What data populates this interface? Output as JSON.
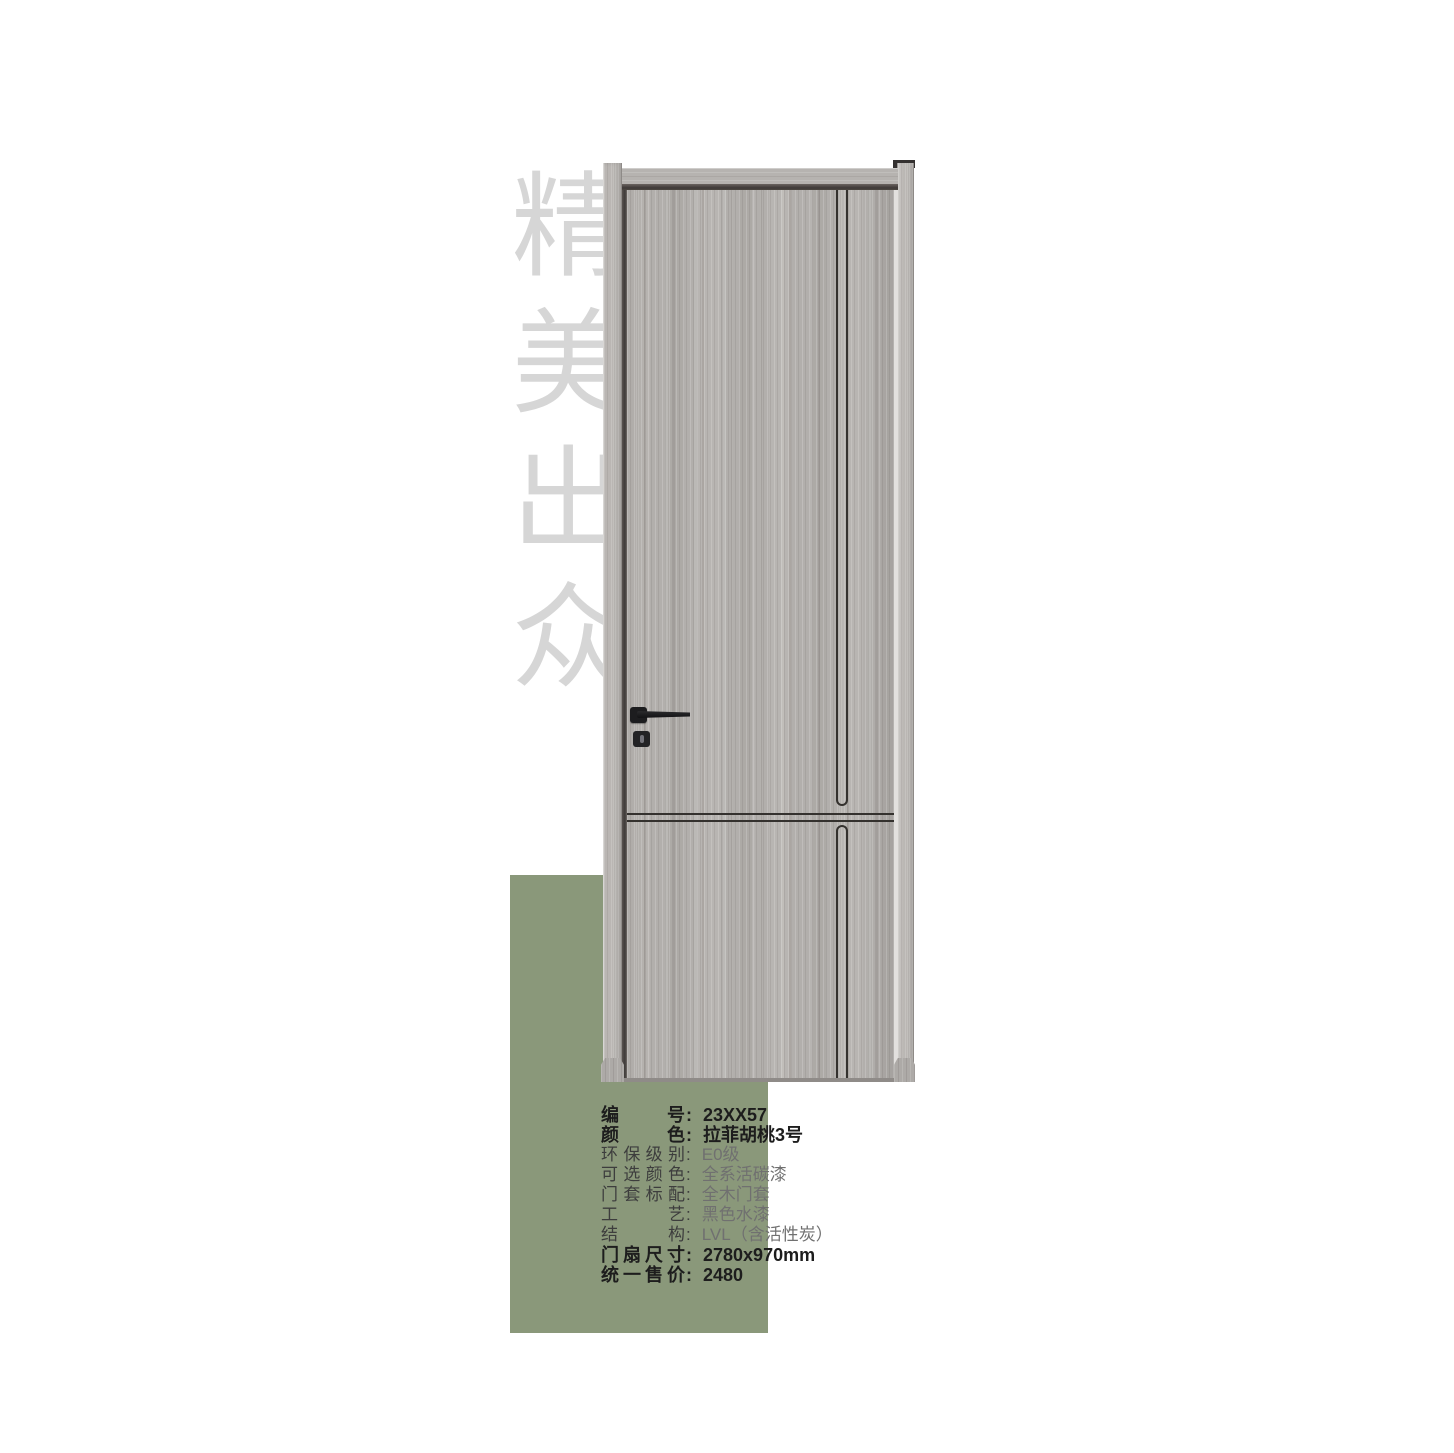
{
  "hero": {
    "vertical_title": "精美出众"
  },
  "panel": {
    "color": "#8a987a"
  },
  "door": {
    "name": "door-product-render",
    "wood_base_color": "#b2afac",
    "frame_color": "#b5b2af",
    "groove_line_color": "#34312e",
    "hardware_color": "#1d1d1f",
    "handle_icon": "lever-handle",
    "lock_icon": "keyhole"
  },
  "specs": {
    "colon": ":",
    "rows": [
      {
        "label": "编号",
        "value": "23XX57"
      },
      {
        "label": "颜色",
        "value": "拉菲胡桃3号"
      },
      {
        "label": "环保级别",
        "value": "E0级"
      },
      {
        "label": "可选颜色",
        "value": "全系活碳漆"
      },
      {
        "label": "门套标配",
        "value": "全木门套"
      },
      {
        "label": "工艺",
        "value": "黑色水漆"
      },
      {
        "label": "结构",
        "value": "LVL（含活性炭）"
      },
      {
        "label": "门扇尺寸",
        "value": "2780x970mm"
      },
      {
        "label": "统一售价",
        "value": "2480"
      }
    ]
  }
}
